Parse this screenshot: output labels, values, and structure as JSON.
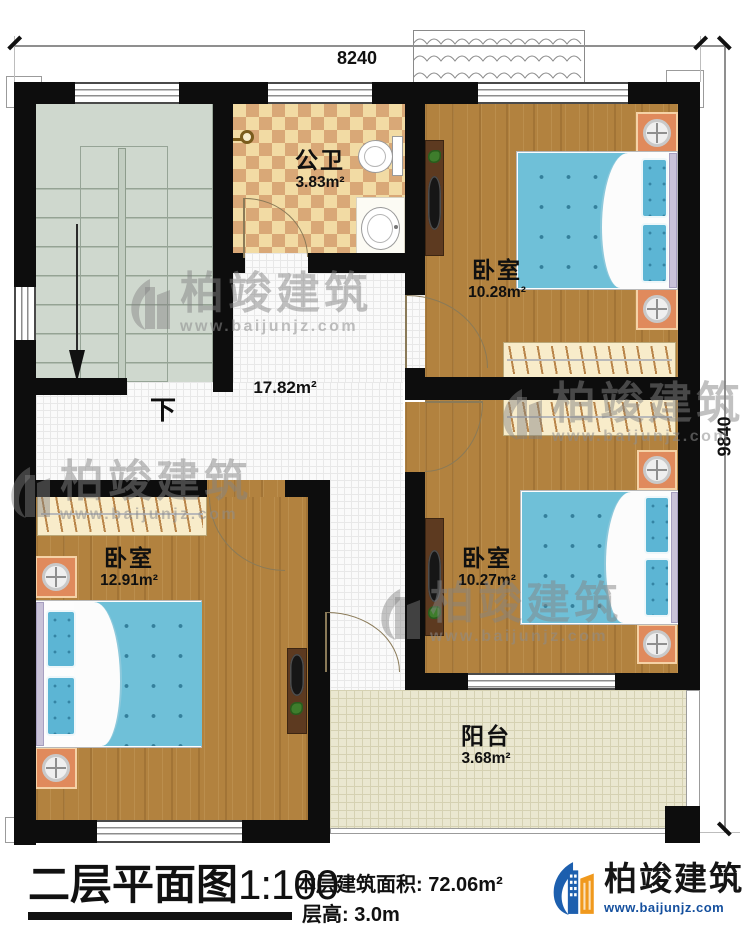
{
  "dimensions": {
    "top": "8240",
    "right": "9840"
  },
  "rooms": {
    "bathroom": {
      "name": "公卫",
      "area": "3.83m²"
    },
    "bedroom_top": {
      "name": "卧室",
      "area": "10.28m²"
    },
    "hall": {
      "area": "17.82m²"
    },
    "bedroom_left": {
      "name": "卧室",
      "area": "12.91m²"
    },
    "bedroom_right": {
      "name": "卧室",
      "area": "10.27m²"
    },
    "balcony": {
      "name": "阳台",
      "area": "3.68m²"
    }
  },
  "stairs": {
    "down_label": "下"
  },
  "titleblock": {
    "plan_title": "二层平面图",
    "plan_scale": "1:100",
    "floor_area_label": "本层建筑面积:",
    "floor_area_value": "72.06m²",
    "floor_height_label": "层高:",
    "floor_height_value": "3.0m"
  },
  "brand": {
    "name": "柏竣建筑",
    "website": "www.baijunjz.com"
  },
  "watermark": {
    "name": "柏竣建筑",
    "website": "www.baijunjz.com"
  },
  "colors": {
    "wall": "#0d0d0d",
    "wood_floor": "#b2823f",
    "bed_blue": "#6fc0d8",
    "stairs": "#cfd8ce",
    "checker_light": "#f2dba4",
    "checker_dark": "#d9a877",
    "balcony_floor": "#eae7d0",
    "brand_blue": "#1d5fae",
    "brand_orange": "#f0991d"
  }
}
